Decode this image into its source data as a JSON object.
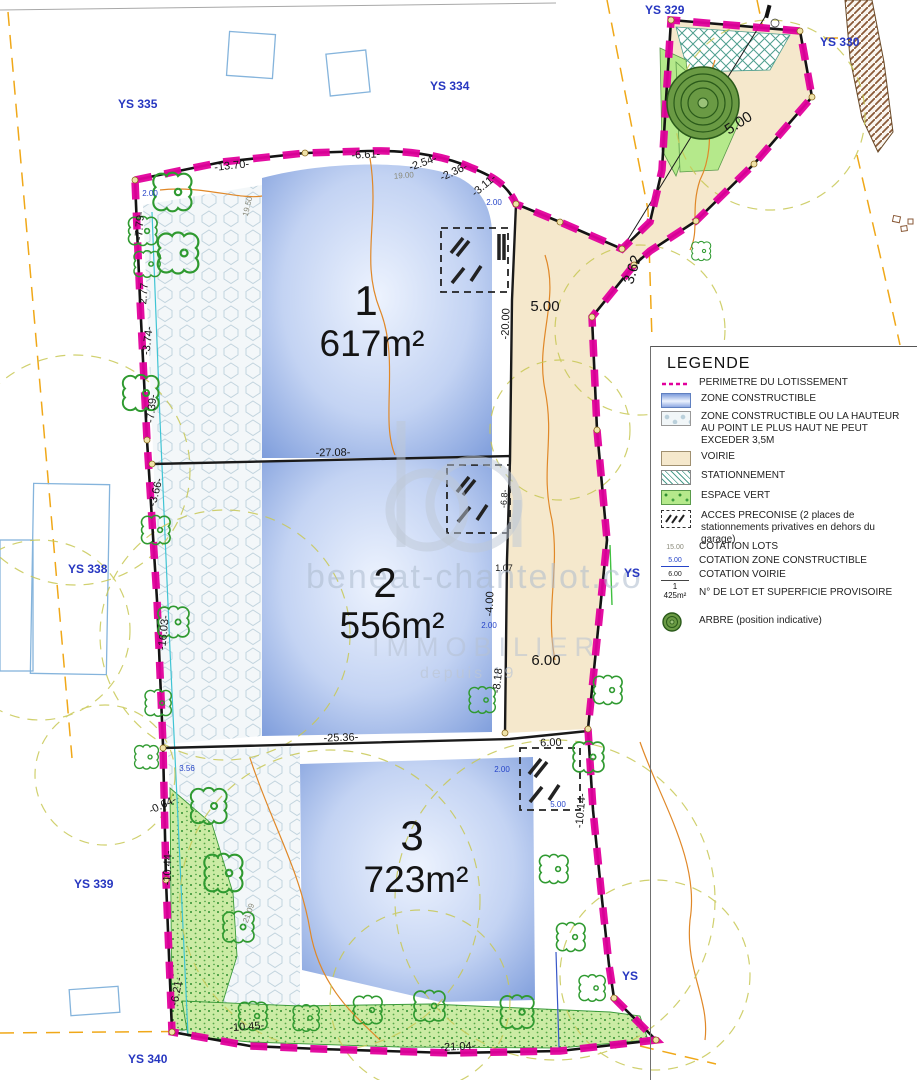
{
  "lots": [
    {
      "number": "1",
      "area": "617m²"
    },
    {
      "number": "2",
      "area": "556m²"
    },
    {
      "number": "3",
      "area": "723m²"
    }
  ],
  "parcel_labels": [
    {
      "t": "YS 329"
    },
    {
      "t": "YS 330"
    },
    {
      "t": "YS 334"
    },
    {
      "t": "YS 335"
    },
    {
      "t": "YS 338"
    },
    {
      "t": "YS 339"
    },
    {
      "t": "YS 340"
    },
    {
      "t": "YS"
    },
    {
      "t": "YS"
    }
  ],
  "dims": [
    {
      "t": "-13.70-"
    },
    {
      "t": "-6.61-"
    },
    {
      "t": "-2.54-"
    },
    {
      "t": "-2.36-"
    },
    {
      "t": "-3.11-"
    },
    {
      "t": "5.00"
    },
    {
      "t": "3.62"
    },
    {
      "t": "5.00"
    },
    {
      "t": "-20.00"
    },
    {
      "t": "-27.08-"
    },
    {
      "t": "6.00"
    },
    {
      "t": "-4.00"
    },
    {
      "t": "-8.18"
    },
    {
      "t": "-25.36-"
    },
    {
      "t": "6.00"
    },
    {
      "t": "-10.14-"
    },
    {
      "t": "-10.45-"
    },
    {
      "t": "-21.04-"
    },
    {
      "t": "-0.64-"
    },
    {
      "t": "-10.44-"
    },
    {
      "t": "-6.21-"
    },
    {
      "t": "-7.79-"
    },
    {
      "t": "2.77"
    },
    {
      "t": "-3.74-"
    },
    {
      "t": "-7.39-"
    },
    {
      "t": "-3.66-"
    },
    {
      "t": "-16.03-"
    },
    {
      "t": "-6.8-"
    },
    {
      "t": "19.00"
    },
    {
      "t": "19.50"
    },
    {
      "t": "21.09"
    },
    {
      "t": "2.00"
    },
    {
      "t": "2.00"
    },
    {
      "t": "2.00"
    },
    {
      "t": "2.00"
    },
    {
      "t": "5.00"
    },
    {
      "t": "3.56"
    },
    {
      "t": "1.07"
    }
  ],
  "legend": {
    "title": "LEGENDE",
    "items": [
      {
        "label": "PERIMETRE DU LOTISSEMENT"
      },
      {
        "label": "ZONE CONSTRUCTIBLE"
      },
      {
        "label": "ZONE CONSTRUCTIBLE OU LA HAUTEUR AU POINT LE PLUS HAUT NE PEUT EXCEDER 3,5M"
      },
      {
        "label": "VOIRIE"
      },
      {
        "label": "STATIONNEMENT"
      },
      {
        "label": "ESPACE VERT"
      },
      {
        "label": "ACCES PRECONISE (2 places de stationnements privatives en dehors du garage)"
      },
      {
        "label": "COTATION LOTS",
        "swatch_text": "15.00"
      },
      {
        "label": "COTATION ZONE CONSTRUCTIBLE",
        "swatch_text": "5.00"
      },
      {
        "label": "COTATION VOIRIE",
        "swatch_text": "6.00"
      },
      {
        "label": "N° DE LOT ET SUPERFICIE PROVISOIRE",
        "swatch_line1": "1",
        "swatch_line2": "425m²"
      },
      {
        "label": "ARBRE (position indicative)"
      }
    ]
  },
  "watermark": {
    "name": "beneat-chantelot.co",
    "tagline": "IMMOBILIER",
    "subline": "depuis 19"
  },
  "colors": {
    "perimeter": "#E2009C",
    "zone_constructible": "#8FA9E2",
    "voirie": "#F5E8CC",
    "espace_vert": "#B5E98B",
    "cadastre": "#F0A818",
    "parcel_label": "#2636C0"
  }
}
